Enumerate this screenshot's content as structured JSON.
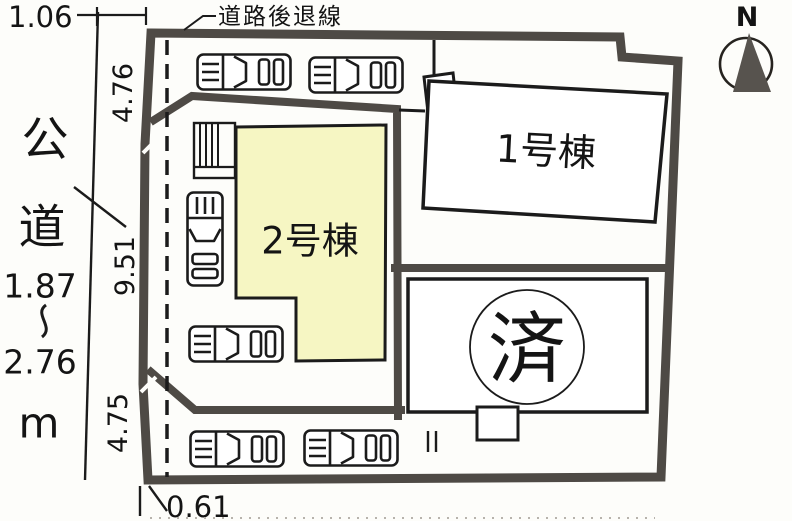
{
  "plan": {
    "compass": {
      "label": "N"
    },
    "setback_line_label": "道路後退線",
    "road": {
      "name_vertical": [
        "公",
        "道"
      ],
      "width_min": "1.87",
      "range_separator": "〜",
      "width_max": "2.76",
      "unit": "m"
    },
    "dims": {
      "top_offset": "1.06",
      "left_seg_upper": "4.76",
      "left_seg_middle": "9.51",
      "left_seg_lower": "4.75",
      "bottom_offset": "0.61"
    },
    "buildings": {
      "b1": {
        "label": "1号棟"
      },
      "b2": {
        "label": "2号棟"
      }
    },
    "sold_lot": {
      "badge": "済"
    },
    "icons": {
      "car": "car-icon",
      "north": "compass-icon",
      "stairs": "stairs-hatch-icon"
    },
    "colors": {
      "boundary": "#4e4a45",
      "line": "#1b1b1b",
      "paper": "#fdfdfa",
      "building2-fill": "#f6f6c3"
    }
  }
}
